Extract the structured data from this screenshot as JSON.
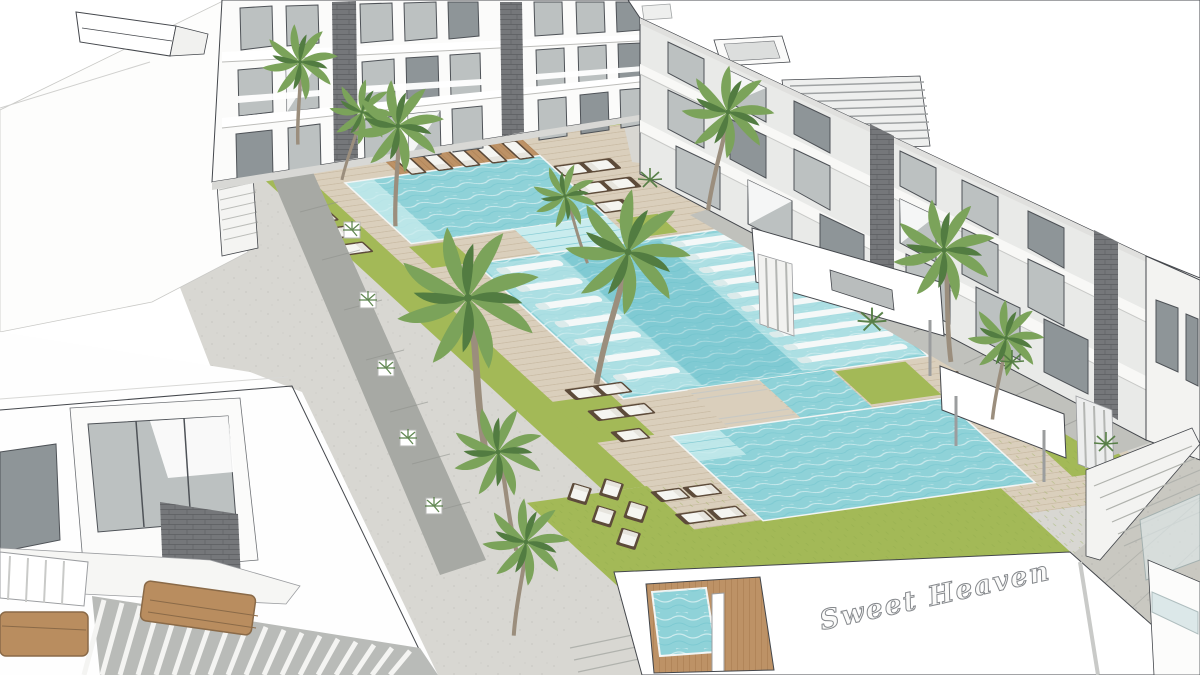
{
  "scene": {
    "sign_text": "Sweet Heaven"
  },
  "colors": {
    "line": "#44474c",
    "pave-light": "#d8d7d2",
    "pave-mid": "#c0c1bc",
    "pave-dark": "#a7a9a4",
    "concrete": "#c9c8c1",
    "deck": "#dacfbc",
    "deck-line": "#c3b49b",
    "island-wood": "#bd9266",
    "grass": "#a3b957",
    "grass-dark": "#8da94a",
    "water": "#8fd2d8",
    "water-deep": "#5fb9c6",
    "water-light": "#c9ecee",
    "glass": "#bcc1c1",
    "glass-dark": "#8e9598",
    "frame": "#4e5257",
    "stone": "#75777a",
    "wall": "#e9eae8",
    "cushion": "#f5f5f1",
    "lounger-dark": "#5d4b3a",
    "palm": "#7ba35a",
    "palm-dark": "#527c41",
    "trunk": "#9b8e7d",
    "sign": "#85888c"
  }
}
